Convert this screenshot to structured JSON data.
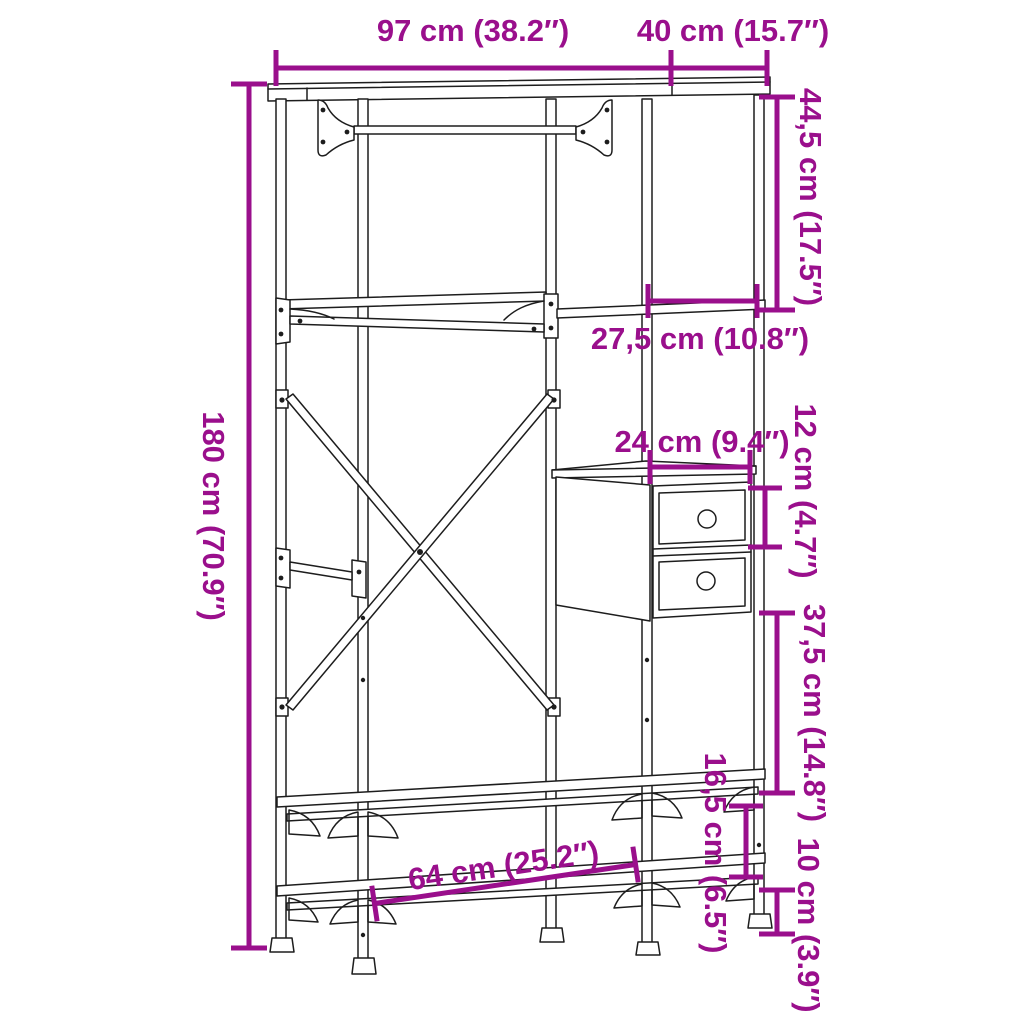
{
  "colors": {
    "background": "#ffffff",
    "line_art": "#1d1d1d",
    "dimension": "#9a0f8c"
  },
  "diagram": {
    "subject": "Wardrobe with drawers and shelves — dimension diagram",
    "annotations": {
      "total_width": "97 cm (38.2″)",
      "depth": "40 cm (15.7″)",
      "top_right_section_height": "44,5 cm (17.5″)",
      "right_shelf_width": "27,5 cm (10.8″)",
      "drawer_unit_width": "24 cm (9.4″)",
      "drawer_height": "12 cm (4.7″)",
      "middle_right_section_height": "37,5 cm (14.8″)",
      "total_height": "180 cm (70.9″)",
      "bottom_shelf_width": "64 cm (25.2″)",
      "shelf_gap_height": "16,5 cm (6.5″)",
      "ground_clearance": "10 cm (3.9″)"
    }
  }
}
